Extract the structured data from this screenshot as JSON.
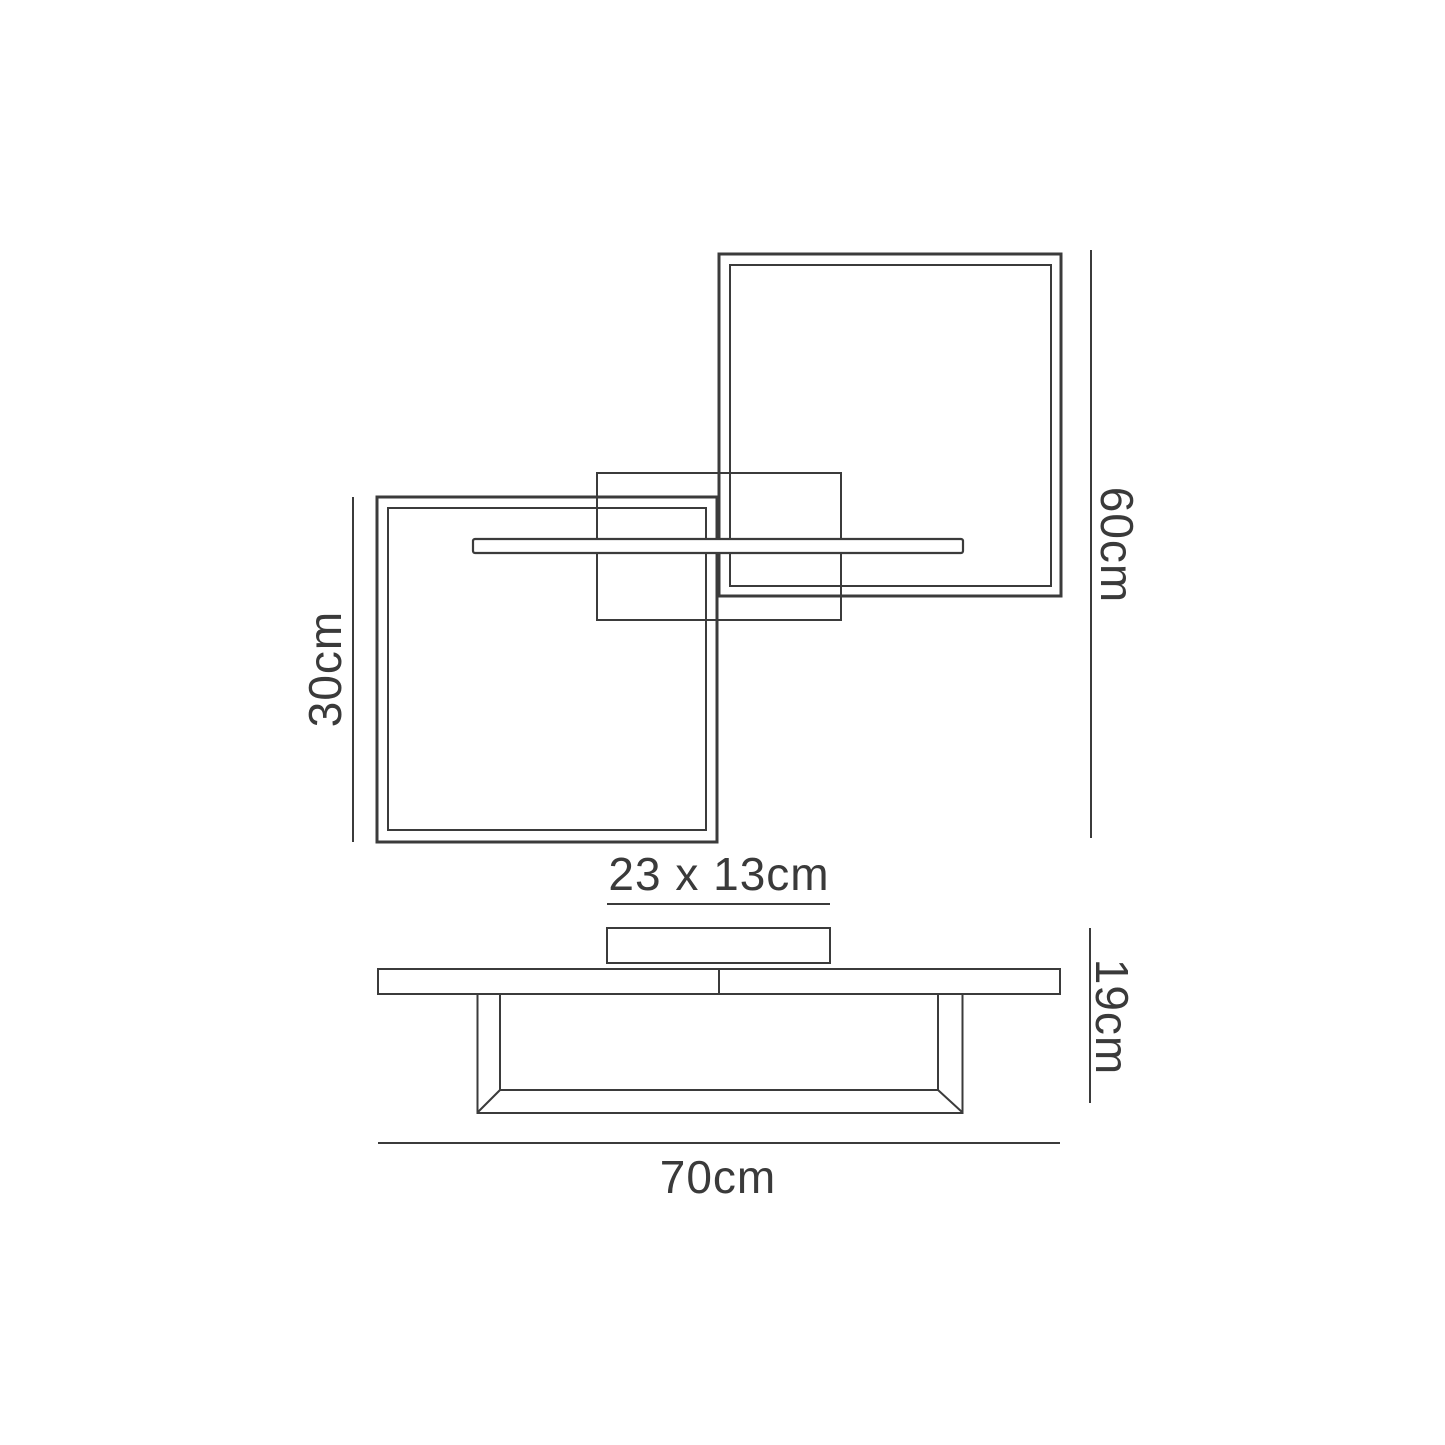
{
  "page": {
    "background_color": "#ffffff",
    "line_color": "#3b3b3b",
    "text_color": "#3a3a3a"
  },
  "diagram": {
    "kind": "product dimension drawing (ceiling light, top view and side view)",
    "dimension_labels": {
      "small_frame_height": "30cm",
      "overall_height": "60cm",
      "canopy_size": "23 x 13cm",
      "fixture_depth": "19cm",
      "overall_width": "70cm"
    }
  }
}
